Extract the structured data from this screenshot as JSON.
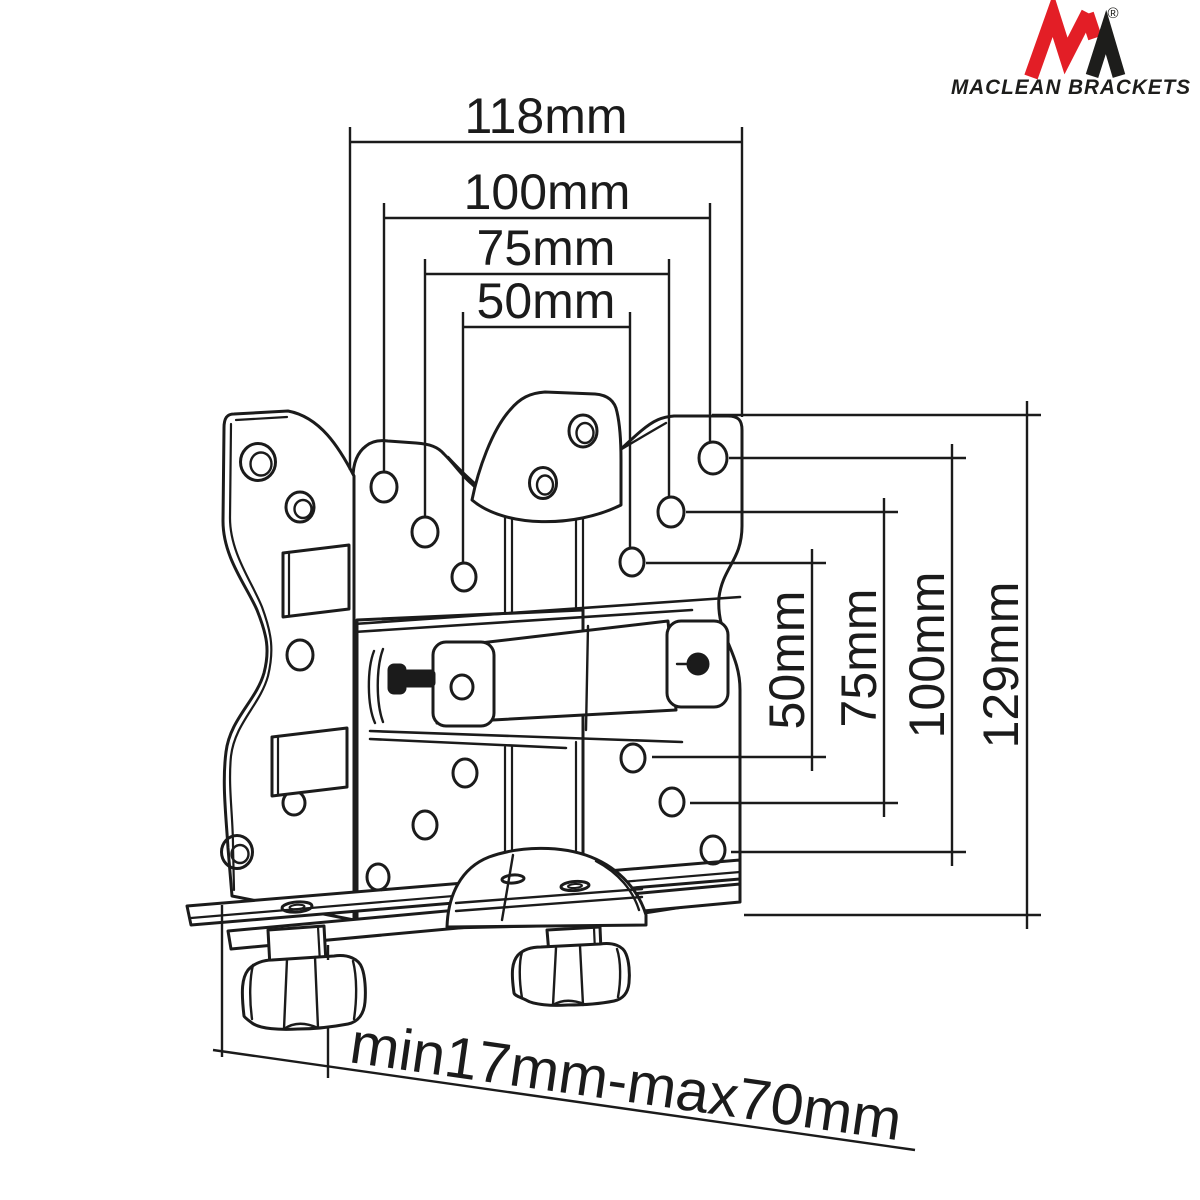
{
  "brand": {
    "name": "MACLEAN BRACKETS",
    "registered_mark": "®"
  },
  "colors": {
    "line": "#1b1b1b",
    "background": "#ffffff",
    "logo_red": "#e31e26",
    "logo_dark": "#1d1d1b"
  },
  "dimensions": {
    "horizontal": [
      {
        "id": "width-118",
        "label": "118mm"
      },
      {
        "id": "width-100",
        "label": "100mm"
      },
      {
        "id": "width-75",
        "label": "75mm"
      },
      {
        "id": "width-50",
        "label": "50mm"
      }
    ],
    "vertical": [
      {
        "id": "height-50",
        "label": "50mm"
      },
      {
        "id": "height-75",
        "label": "75mm"
      },
      {
        "id": "height-100",
        "label": "100mm"
      },
      {
        "id": "height-129",
        "label": "129mm"
      }
    ],
    "clamp_range": {
      "id": "clamp-thickness-range",
      "label": "min17mm-max70mm"
    }
  }
}
